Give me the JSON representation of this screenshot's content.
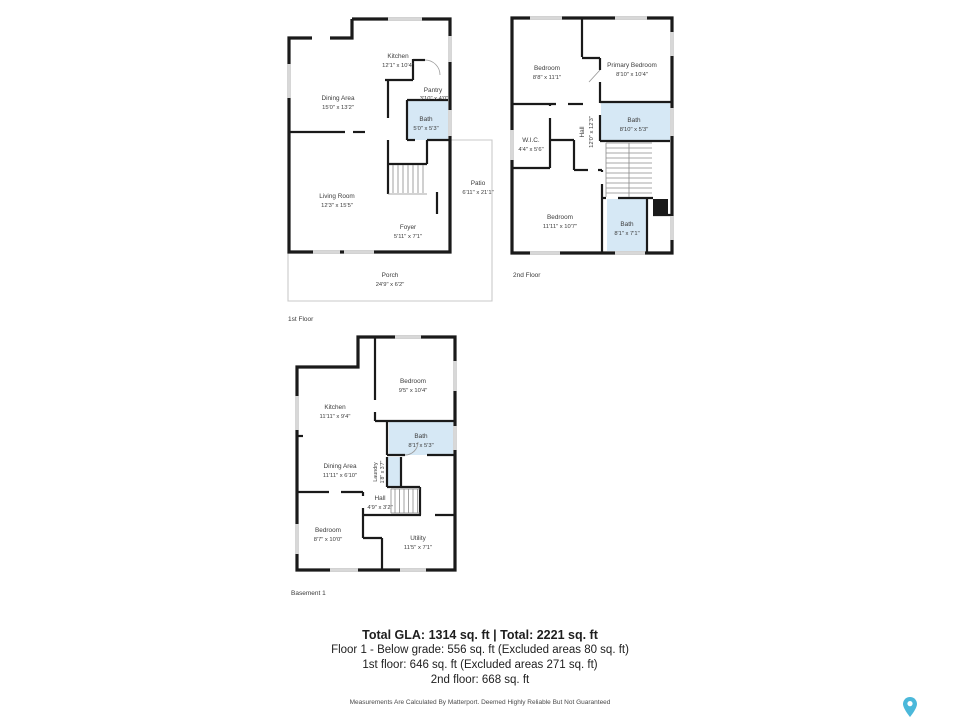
{
  "floors": [
    {
      "label": "1st Floor",
      "rooms": [
        {
          "name": "Kitchen",
          "dims": "12'1\" x 10'4\""
        },
        {
          "name": "Dining Area",
          "dims": "15'0\" x 13'2\""
        },
        {
          "name": "Pantry",
          "dims": "3'10\" x 4'0\""
        },
        {
          "name": "Bath",
          "dims": "5'0\" x 5'3\""
        },
        {
          "name": "Living Room",
          "dims": "12'3\" x 15'5\""
        },
        {
          "name": "Foyer",
          "dims": "5'11\" x 7'1\""
        },
        {
          "name": "Patio",
          "dims": "6'11\" x 21'1\""
        },
        {
          "name": "Porch",
          "dims": "24'9\" x 6'2\""
        }
      ]
    },
    {
      "label": "2nd Floor",
      "rooms": [
        {
          "name": "Bedroom",
          "dims": "8'8\" x 11'1\""
        },
        {
          "name": "Primary Bedroom",
          "dims": "8'10\" x 10'4\""
        },
        {
          "name": "Bath",
          "dims": "8'10\" x 5'3\""
        },
        {
          "name": "Hall",
          "dims": "12'0\" x 12'3\""
        },
        {
          "name": "W.I.C.",
          "dims": "4'4\" x 5'6\""
        },
        {
          "name": "Bedroom",
          "dims": "11'11\" x 10'7\""
        },
        {
          "name": "Bath",
          "dims": "8'1\" x 7'1\""
        }
      ]
    },
    {
      "label": "Basement 1",
      "rooms": [
        {
          "name": "Bedroom",
          "dims": "9'5\" x 10'4\""
        },
        {
          "name": "Kitchen",
          "dims": "11'11\" x 9'4\""
        },
        {
          "name": "Bath",
          "dims": "8'1\" x 5'3\""
        },
        {
          "name": "Dining Area",
          "dims": "11'11\" x 6'10\""
        },
        {
          "name": "Laundry",
          "dims": "1'8\" x 3'7\""
        },
        {
          "name": "Hall",
          "dims": "4'9\" x 3'2\""
        },
        {
          "name": "Bedroom",
          "dims": "8'7\" x 10'0\""
        },
        {
          "name": "Utility",
          "dims": "11'5\" x 7'1\""
        }
      ]
    }
  ],
  "summary": {
    "title": "Total GLA: 1314 sq. ft | Total: 2221 sq. ft",
    "lines": [
      "Floor 1 - Below grade: 556 sq. ft (Excluded areas 80 sq. ft)",
      "1st floor: 646 sq. ft (Excluded areas 271 sq. ft)",
      "2nd floor: 668 sq. ft"
    ],
    "disclaimer": "Measurements Are Calculated By Matterport. Deemed Highly Reliable But Not Guaranteed"
  },
  "colors": {
    "wall": "#1a1a1a",
    "bath_fill": "#d6e8f5",
    "window_fill": "#d8d8d8",
    "thin_outline": "#c9c9c9",
    "label_text": "#3c3c3c",
    "logo_teal": "#4bb8da"
  },
  "logo": {
    "name": "matterport-pin"
  }
}
